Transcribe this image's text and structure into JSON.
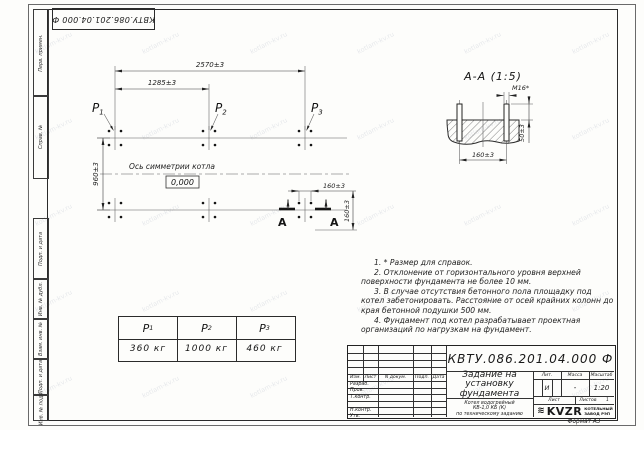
{
  "doc_number": "КВТУ.086.201.04.000  Ф",
  "watermark": {
    "text": "kotlam-kv.ru"
  },
  "margin_column": {
    "labels": [
      "Перв. примен.",
      "Справ. №",
      "Подп. и дата",
      "Инв. № дубл.",
      "Взам. инв. №",
      "Подп. и дата",
      "Инв. № подл."
    ]
  },
  "plan": {
    "dim_2570": "2570±3",
    "dim_1285": "1285±3",
    "dim_960": "960±3",
    "dim_160_h": "160±3",
    "dim_160_v": "160±3",
    "axis_label": "Ось симметрии котла",
    "level": "0,000",
    "section_letter_left": "А",
    "section_letter_right": "А",
    "loads": [
      {
        "name": "P",
        "sub": "1"
      },
      {
        "name": "P",
        "sub": "2"
      },
      {
        "name": "P",
        "sub": "3"
      }
    ]
  },
  "section": {
    "title": "А-А  (1:5)",
    "thread": "М16*",
    "dim_160": "160±3",
    "dim_50": "50±3"
  },
  "load_table": {
    "headers": [
      {
        "name": "P",
        "sub": "1"
      },
      {
        "name": "P",
        "sub": "2"
      },
      {
        "name": "P",
        "sub": "3"
      }
    ],
    "values": [
      "360  кг",
      "1000  кг",
      "460  кг"
    ]
  },
  "notes": [
    "1. * Размер для справок.",
    "2. Отклонение от горизонтального уровня верхней поверхности фундамента не более 10 мм.",
    "3. В случае отсутствия бетонного пола площадку под котел забетонировать. Расстояние от осей крайних колонн до края бетонной подушки 500 мм.",
    "4. Фундамент под котел разрабатывает проектная организаций по нагрузкам на фундамент."
  ],
  "title_block": {
    "header_cells": [
      "Изм.",
      "Лист",
      "N докум.",
      "Подп.",
      "Дата"
    ],
    "row_labels": [
      "Разраб.",
      "Пров.",
      "Т.контр.",
      "Н.контр.",
      "Утв."
    ],
    "title_lines": [
      "Задание на",
      "установку",
      "фундамента"
    ],
    "subtitle_lines": [
      "Котел водогрейный",
      "КВ-1,0 КБ (К)",
      "по техническому заданию"
    ],
    "lit_label": "Лит.",
    "massa_label": "Масса",
    "masshtab_label": "Масштаб",
    "lit_value": "И",
    "massa_value": "-",
    "masshtab_value": "1:20",
    "list_label": "Лист",
    "listov_label": "Листов",
    "listov_value": "1",
    "logo_icon": "≋",
    "logo_word": "KVZR",
    "logo_line1": "КОТЕЛЬНЫЙ",
    "logo_line2": "ЗАВОД РЭП",
    "format_label": "Формат А3"
  }
}
